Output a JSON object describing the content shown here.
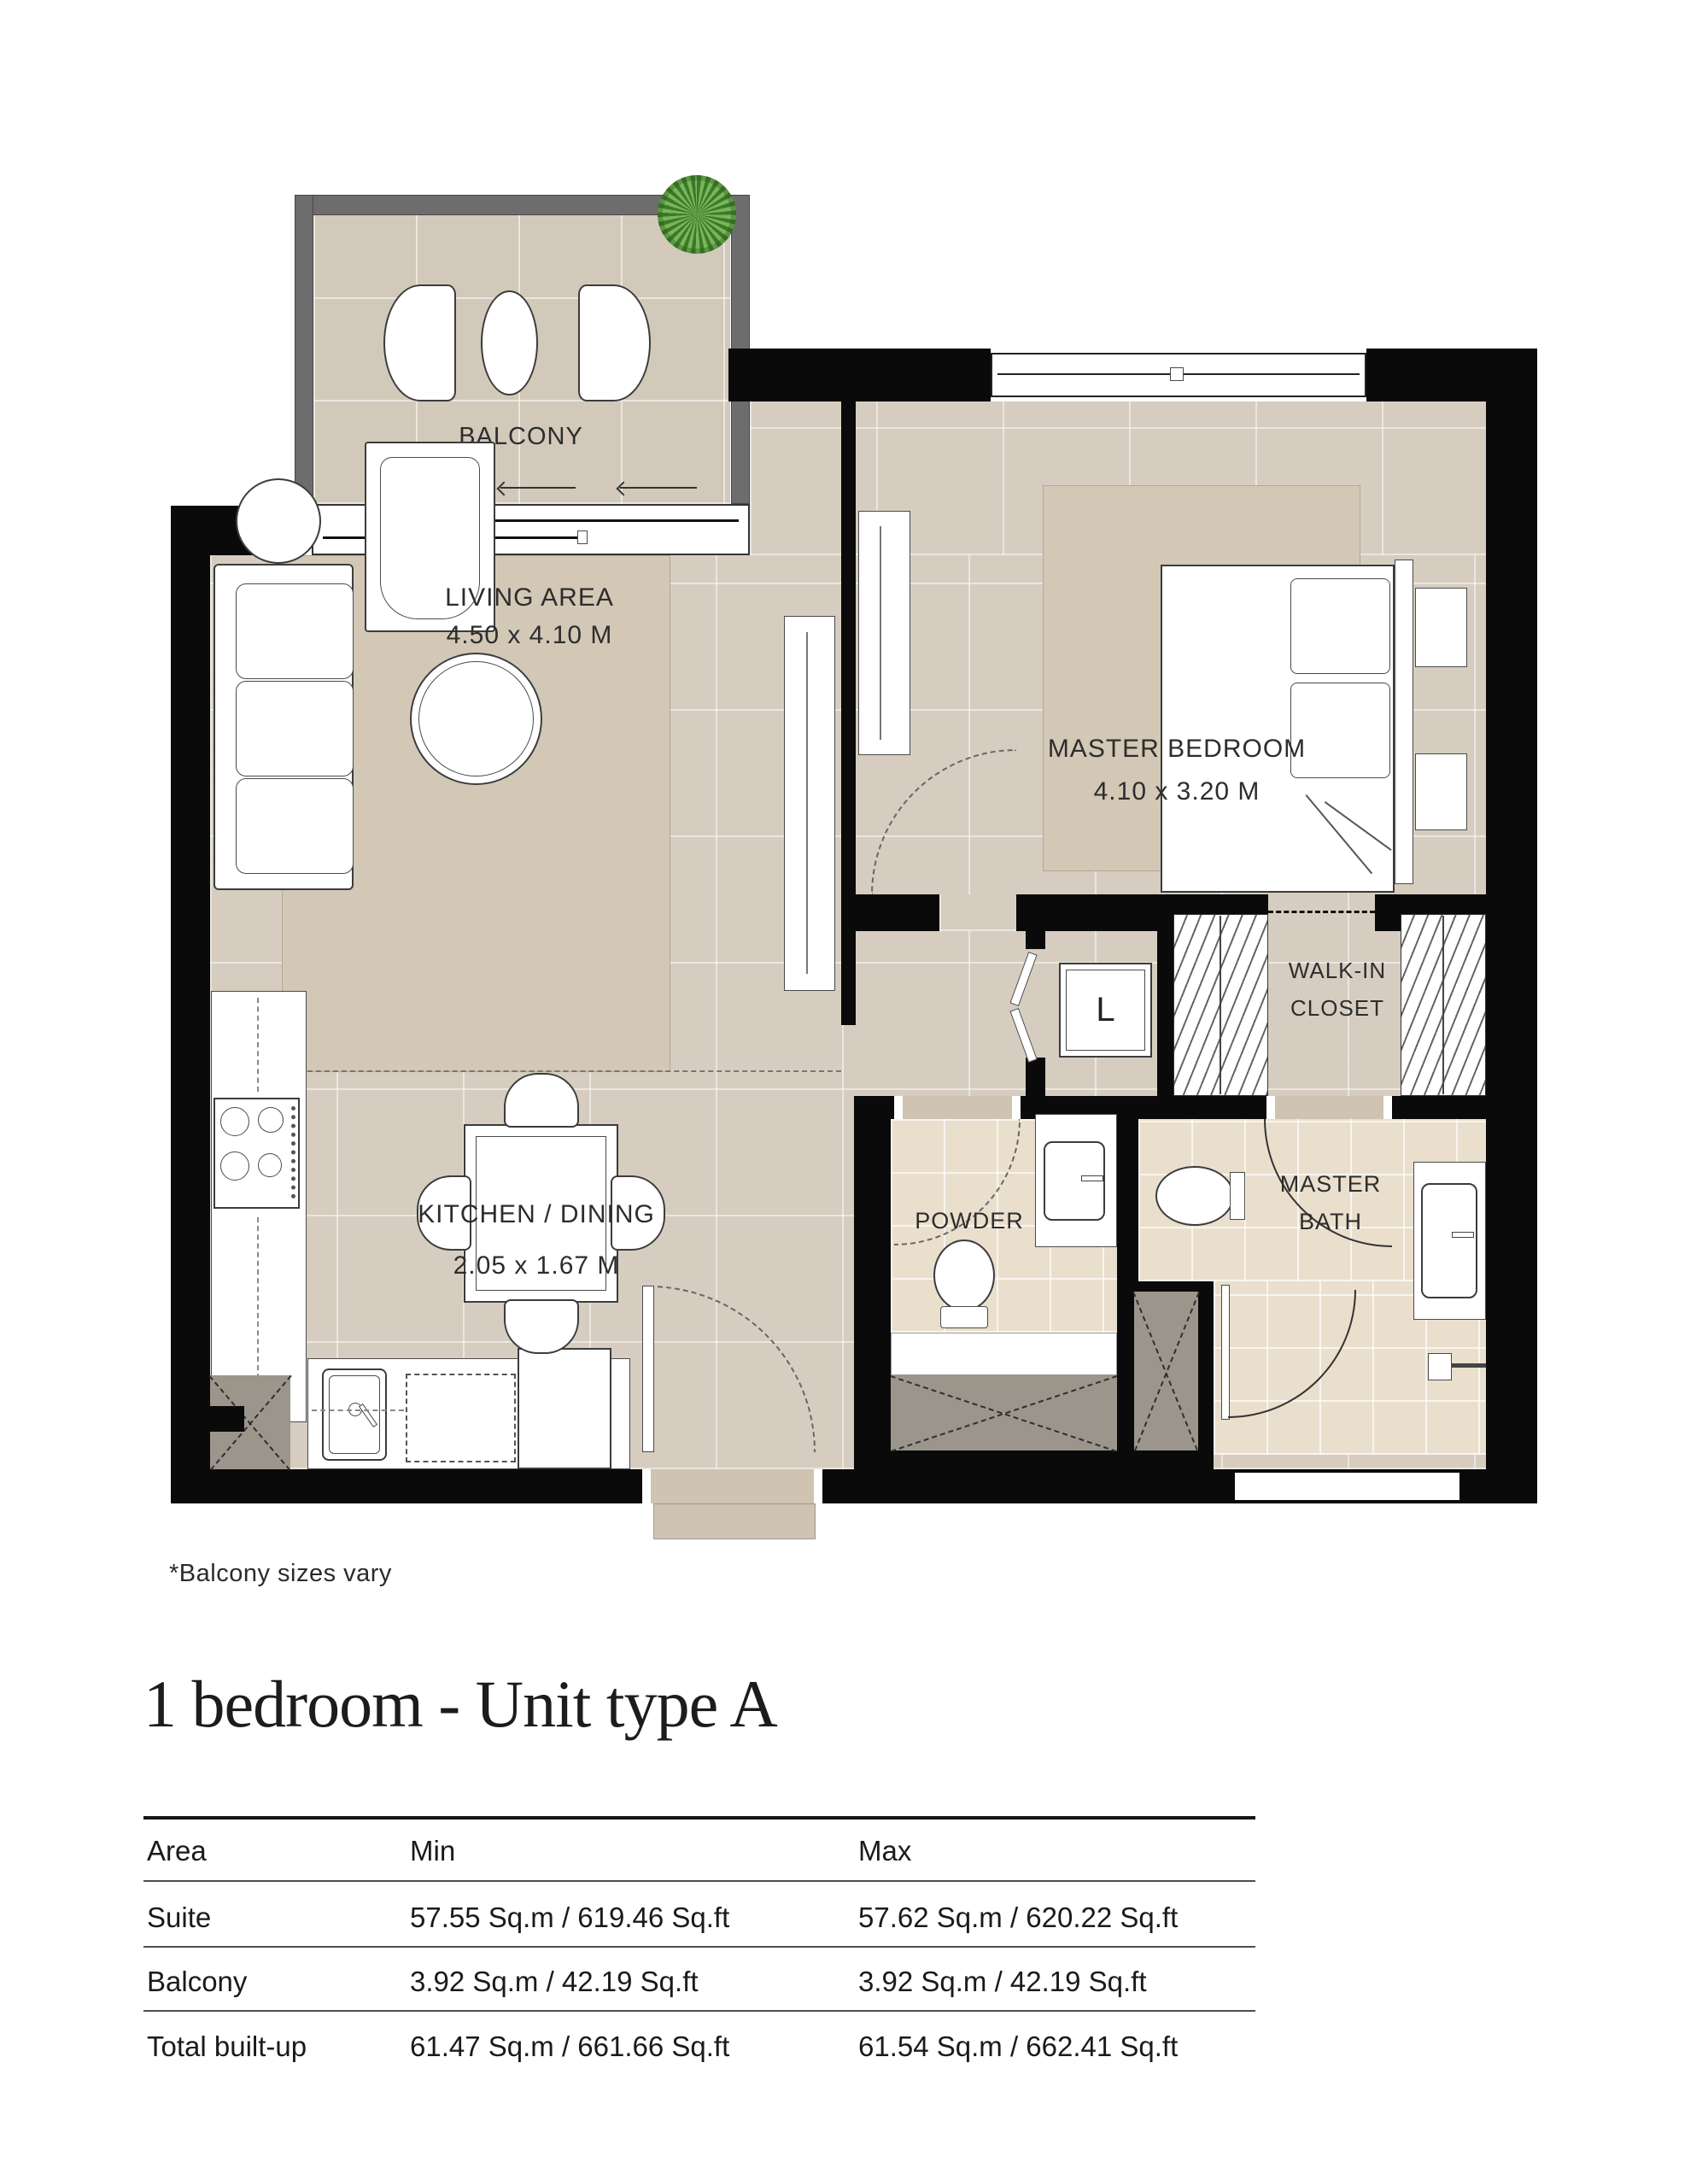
{
  "floorplan": {
    "balcony": {
      "name": "BALCONY"
    },
    "living_area": {
      "name": "LIVING AREA",
      "dimensions": "4.50 x 4.10 M"
    },
    "master_bedroom": {
      "name": "MASTER BEDROOM",
      "dimensions": "4.10 x 3.20 M"
    },
    "kitchen_dining": {
      "name": "KITCHEN / DINING",
      "dimensions": "2.05 x 1.67 M"
    },
    "walk_in_closet": {
      "line1": "WALK-IN",
      "line2": "CLOSET"
    },
    "laundry": {
      "abbr": "L"
    },
    "powder_room": {
      "name": "POWDER"
    },
    "master_bath": {
      "line1": "MASTER",
      "line2": "BATH"
    }
  },
  "footnote": "*Balcony sizes vary",
  "unit_title": "1 bedroom - Unit type A",
  "area_table": {
    "columns": [
      "Area",
      "Min",
      "Max"
    ],
    "rows": [
      {
        "area": "Suite",
        "min": "57.55 Sq.m / 619.46 Sq.ft",
        "max": "57.62 Sq.m / 620.22 Sq.ft"
      },
      {
        "area": "Balcony",
        "min": "3.92 Sq.m / 42.19 Sq.ft",
        "max": "3.92 Sq.m / 42.19 Sq.ft"
      },
      {
        "area": "Total built-up",
        "min": "61.47 Sq.m / 661.66 Sq.ft",
        "max": "61.54 Sq.m / 662.41 Sq.ft"
      }
    ]
  },
  "colors": {
    "wall": "#0a0a0a",
    "balcony_wall": "#6d6d6d",
    "floor": "#d6cdc0",
    "rug": "#d3c8b6",
    "bath_tile": "#e9dfcc",
    "shaft": "#9b958b",
    "plant": "#4e8a3a"
  }
}
